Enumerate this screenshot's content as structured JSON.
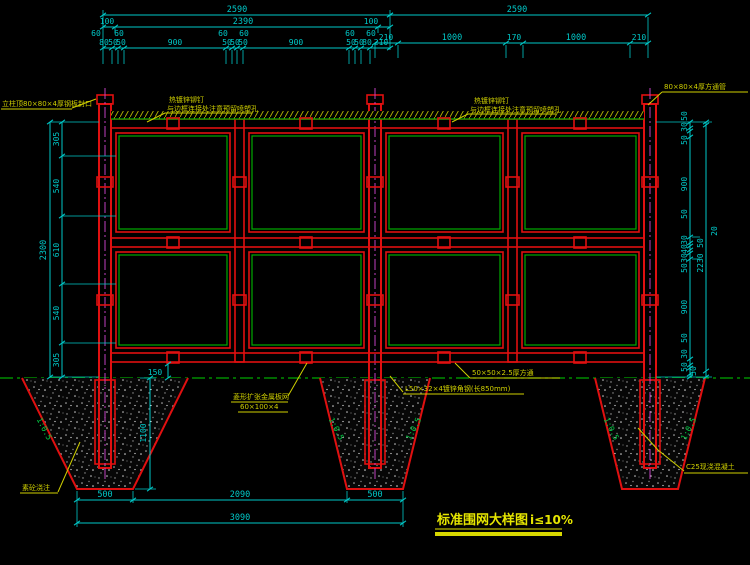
{
  "drawing": {
    "title": "标准围网大样图",
    "title_suffix": "i≤10%"
  },
  "annotations": {
    "post_cap": "立柱顶80×80×4厚钢板封口",
    "rivet1": "热镀锌铆钉",
    "rivet2": "与边框连接处注意预留喷塑孔",
    "square_tube_post": "80×80×4厚方通管",
    "mesh1": "菱形扩张金属板网",
    "mesh2": "60×100×4",
    "frame_tube": "50×50×2.5厚方通",
    "angle_steel": "L50×32×4镀锌角钢(长850mm)",
    "cast_concrete": "C25现浇混凝土",
    "plain_concrete": "素砼浇注",
    "slope": "1:0.5"
  },
  "dims": {
    "top_left": {
      "total": "2590",
      "sub": [
        "100",
        "2390",
        "100"
      ],
      "offsets": [
        "60",
        "60",
        "60",
        "60",
        "60",
        "60"
      ],
      "detail": [
        "80",
        "50",
        "50",
        "900",
        "50",
        "50",
        "50",
        "900",
        "50",
        "50",
        "80",
        "210"
      ]
    },
    "top_right": {
      "total": "2590",
      "detail": [
        "210",
        "1000",
        "170",
        "1000",
        "210"
      ]
    },
    "left": {
      "total": "2300",
      "segments": [
        "305",
        "540",
        "610",
        "540",
        "305"
      ]
    },
    "right_inner": [
      "50",
      "30",
      "50",
      "900",
      "50",
      "30",
      "40",
      "30",
      "50",
      "900",
      "50",
      "30",
      "50"
    ],
    "right_outer": [
      "20",
      "50",
      "2230",
      "50"
    ],
    "bottom": {
      "detail": [
        "500",
        "2090",
        "500"
      ],
      "total": "3090"
    },
    "footing_depth": "1100",
    "bottom_clearance": "150"
  },
  "colors": {
    "frame_red": "#e01010",
    "mesh_green": "#00aa00",
    "dim_cyan": "#00c8c8",
    "note_yellow": "#cfcf00",
    "center_magenta": "#c040c0",
    "slope_green": "#00cc44"
  }
}
